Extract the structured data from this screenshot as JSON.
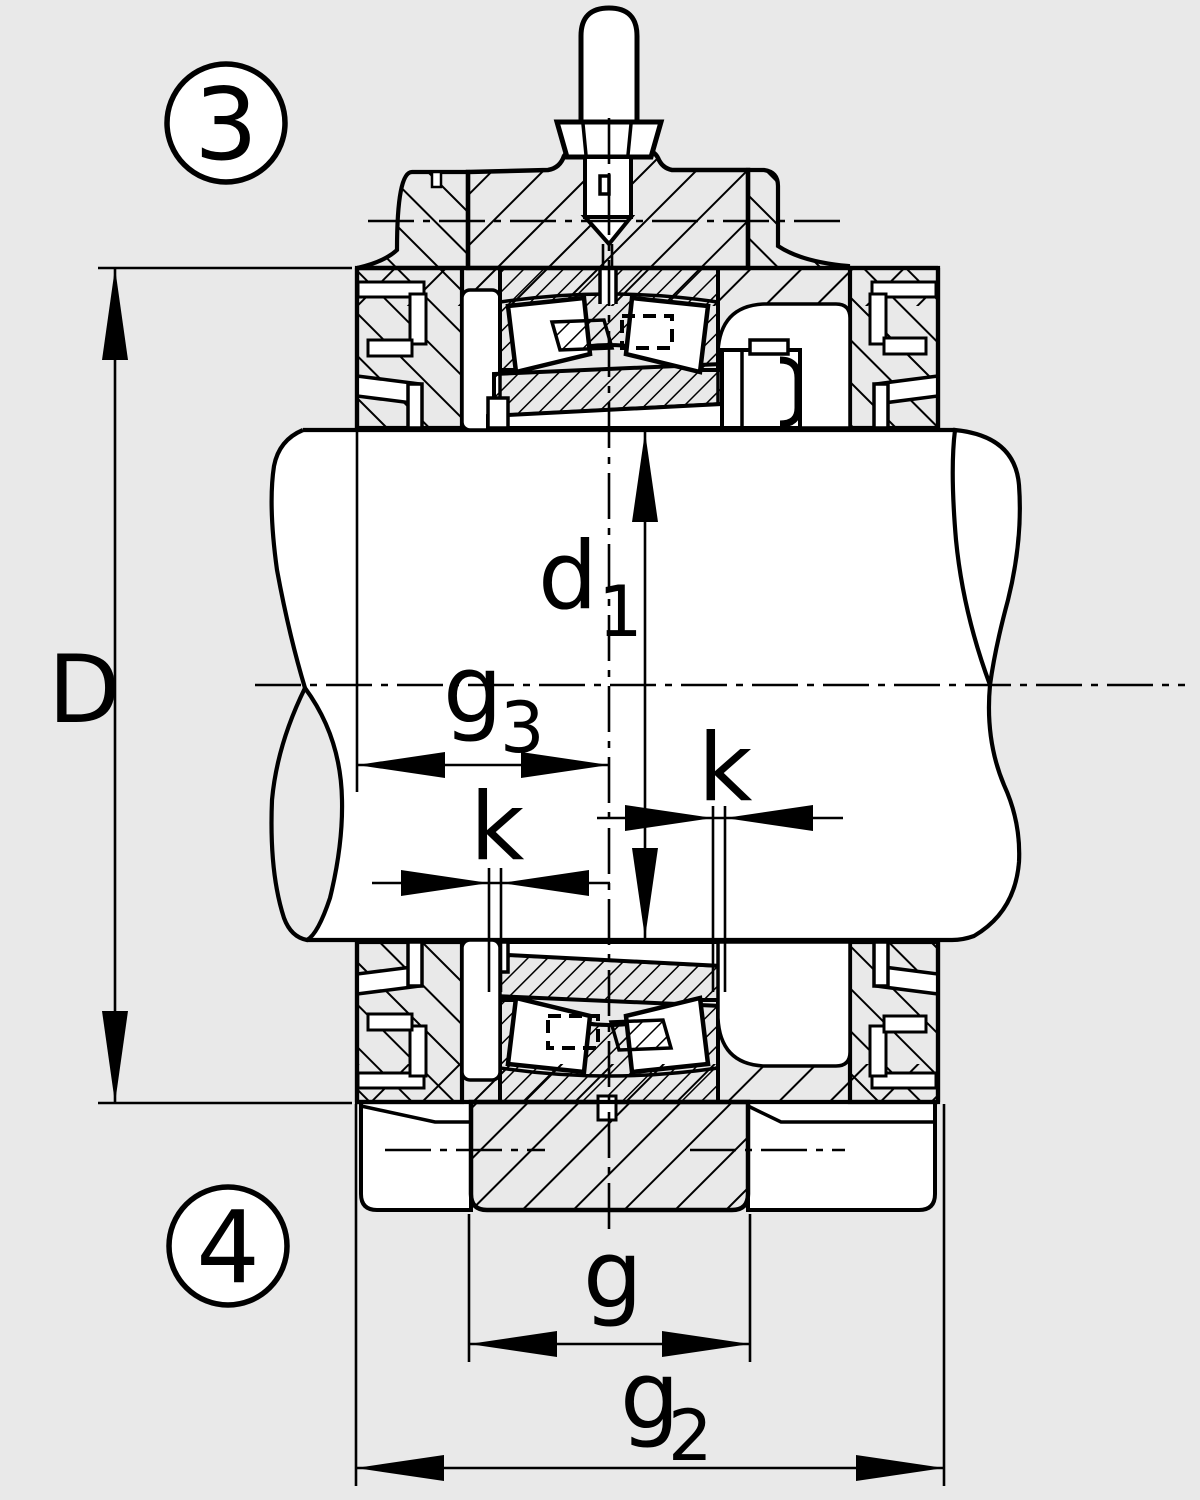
{
  "colors": {
    "background": "#e9e9e9",
    "ink": "#000000",
    "paper": "#ffffff"
  },
  "labels": {
    "D": "D",
    "d1": {
      "base": "d",
      "sub": "1"
    },
    "g3": {
      "base": "g",
      "sub": "3"
    },
    "k_left": "k",
    "k_right": "k",
    "g": "g",
    "g2": {
      "base": "g",
      "sub": "2"
    }
  },
  "callouts": [
    {
      "number": "3"
    },
    {
      "number": "4"
    }
  ]
}
